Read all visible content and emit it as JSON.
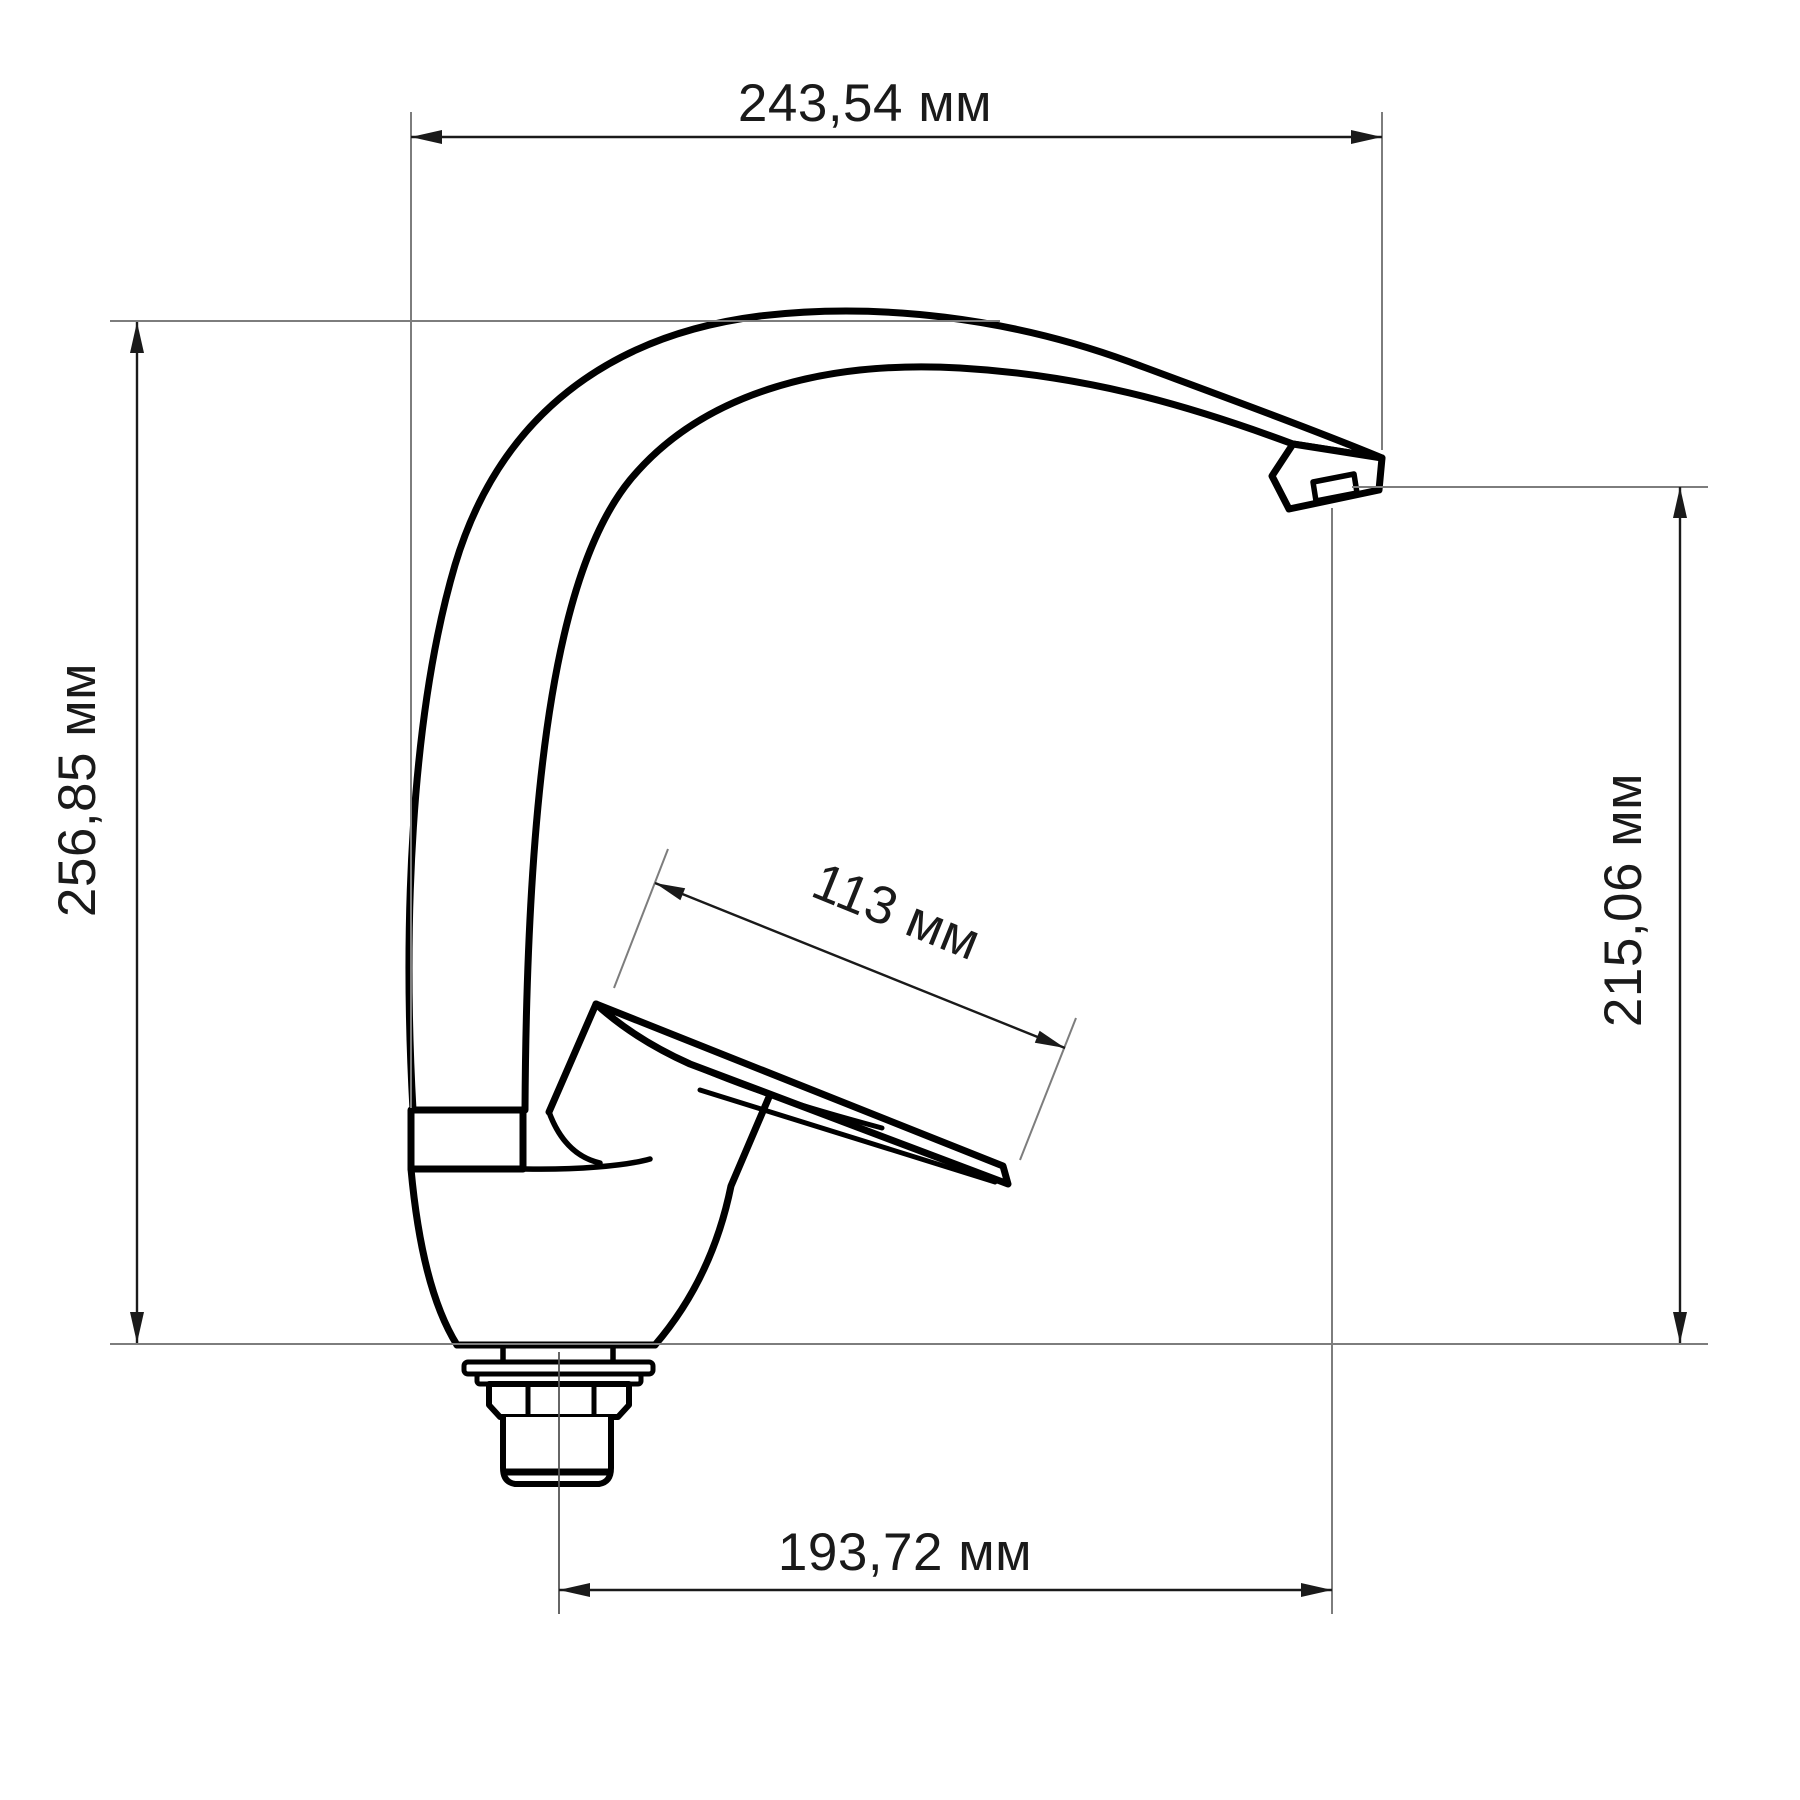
{
  "drawing": {
    "subject": "kitchen-faucet-side-view-technical-drawing",
    "unit": "мм",
    "colors": {
      "background": "#ffffff",
      "outline": "#000000",
      "dimension_line": "#1a1a1a",
      "extension_line": "#7d7d7d",
      "text": "#1a1a1a"
    },
    "dimensions": {
      "overall_width": {
        "value": "243,54",
        "unit": "мм",
        "label": "243,54 мм"
      },
      "overall_height": {
        "value": "256,85",
        "unit": "мм",
        "label": "256,85 мм"
      },
      "spout_outlet_height": {
        "value": "215,06",
        "unit": "мм",
        "label": "215,06 мм"
      },
      "handle_length": {
        "value": "113",
        "unit": "мм",
        "label": "113 мм"
      },
      "spout_reach": {
        "value": "193,72",
        "unit": "мм",
        "label": "193,72 мм"
      }
    }
  }
}
